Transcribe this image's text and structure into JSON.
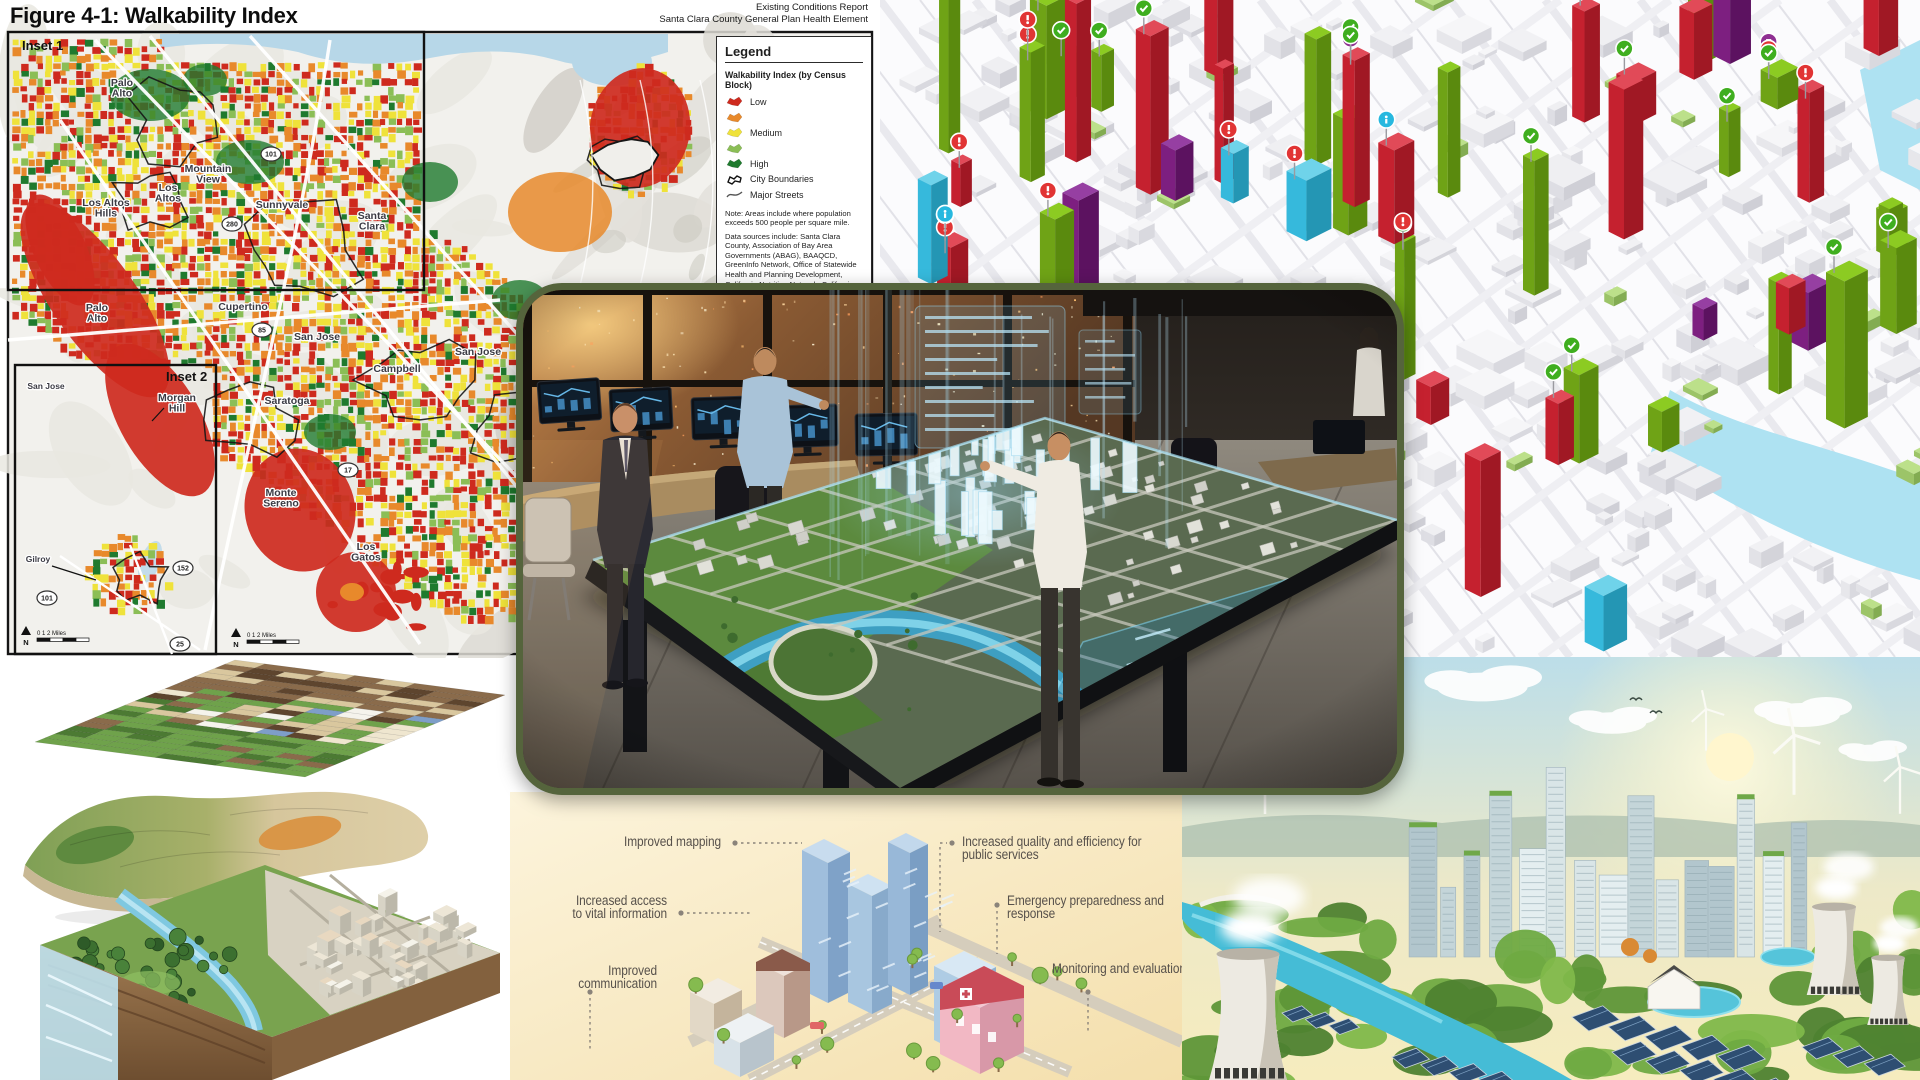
{
  "walkability_map": {
    "title": "Figure 4-1: Walkability Index",
    "report_line1": "Existing Conditions Report",
    "report_line2": "Santa Clara County General Plan Health Element",
    "inset1_label": "Inset 1",
    "inset2_label": "Inset 2",
    "legend": {
      "title": "Legend",
      "section_title": "Walkability Index (by Census Block)",
      "items": [
        {
          "label": "Low",
          "swatch": "blob",
          "color": "#CE2A1E"
        },
        {
          "label": "",
          "swatch": "blob",
          "color": "#E8892B"
        },
        {
          "label": "Medium",
          "swatch": "blob",
          "color": "#EFE23A"
        },
        {
          "label": "",
          "swatch": "blob",
          "color": "#8BBE56"
        },
        {
          "label": "High",
          "swatch": "blob",
          "color": "#1F7A2E"
        },
        {
          "label": "City Boundaries",
          "swatch": "boundary",
          "color": "#111111"
        },
        {
          "label": "Major Streets",
          "swatch": "street",
          "color": "#555555"
        }
      ],
      "note": "Note:  Areas include where population exceeds 500 people per square mile.",
      "sources": "Data sources include:  Santa Clara County, Association of Bay Area Governments (ABAG),  BAAQCD, GreenInfo Network, Office of Statewide Health and Planning Development, California Nutrition Network, California"
    },
    "city_labels": [
      {
        "text": "Palo\nAlto",
        "x": 122,
        "y": 86
      },
      {
        "text": "Mountain\nView",
        "x": 208,
        "y": 172
      },
      {
        "text": "Los\nAltos",
        "x": 168,
        "y": 191
      },
      {
        "text": "Los Altos\nHills",
        "x": 106,
        "y": 206
      },
      {
        "text": "Sunnyvale",
        "x": 282,
        "y": 208
      },
      {
        "text": "Santa\nClara",
        "x": 372,
        "y": 219
      },
      {
        "text": "Palo\nAlto",
        "x": 97,
        "y": 311
      },
      {
        "text": "Cupertino",
        "x": 243,
        "y": 310
      },
      {
        "text": "San Jose",
        "x": 317,
        "y": 340
      },
      {
        "text": "San Jose",
        "x": 478,
        "y": 355
      },
      {
        "text": "Campbell",
        "x": 397,
        "y": 372
      },
      {
        "text": "Saratoga",
        "x": 287,
        "y": 404
      },
      {
        "text": "Morgan\nHill",
        "x": 177,
        "y": 401
      },
      {
        "text": "Monte\nSereno",
        "x": 281,
        "y": 496
      },
      {
        "text": "Los\nGatos",
        "x": 366,
        "y": 550
      },
      {
        "text": "San Jose",
        "x": 46,
        "y": 389
      },
      {
        "text": "Gilroy",
        "x": 38,
        "y": 562
      }
    ],
    "route_shields": [
      {
        "num": "101",
        "x": 271,
        "y": 154
      },
      {
        "num": "280",
        "x": 232,
        "y": 224
      },
      {
        "num": "85",
        "x": 262,
        "y": 330
      },
      {
        "num": "17",
        "x": 348,
        "y": 470
      },
      {
        "num": "152",
        "x": 183,
        "y": 568
      },
      {
        "num": "25",
        "x": 180,
        "y": 644
      },
      {
        "num": "101",
        "x": 47,
        "y": 598
      }
    ],
    "scale": {
      "north_label": "N",
      "distance_label": "0    1    2 Miles"
    }
  },
  "infographic": {
    "callouts_left": [
      {
        "lines": "Improved mapping",
        "top": 44,
        "width": 211
      },
      {
        "lines": "Increased access\nto vital information",
        "top": 103,
        "width": 157
      },
      {
        "lines": "Improved communication",
        "top": 173,
        "width": 147
      }
    ],
    "callouts_right": [
      {
        "lines": "Increased quality and efficiency for\npublic services",
        "top": 44,
        "left": 452
      },
      {
        "lines": "Emergency preparedness and\nresponse",
        "top": 103,
        "left": 497
      },
      {
        "lines": "Monitoring and evaluation",
        "top": 171,
        "left": 542
      }
    ],
    "accent_text_color": "#57514B",
    "background_color": "#F8E9C2"
  },
  "palette": {
    "walk_low": "#CE2A1E",
    "walk_low_mid": "#E8892B",
    "walk_medium": "#EFE23A",
    "walk_high_mid": "#8BBE56",
    "walk_high": "#1F7A2E",
    "map_water": "#B7D7E8",
    "model_green": "#7CBF1B",
    "model_red": "#D6283C",
    "model_purple": "#7D1F80",
    "model_cyan": "#36B9DC",
    "photo_frame": "#55643C",
    "holo_blue": "#9FE4FF",
    "eco_water": "#45BCD6"
  }
}
